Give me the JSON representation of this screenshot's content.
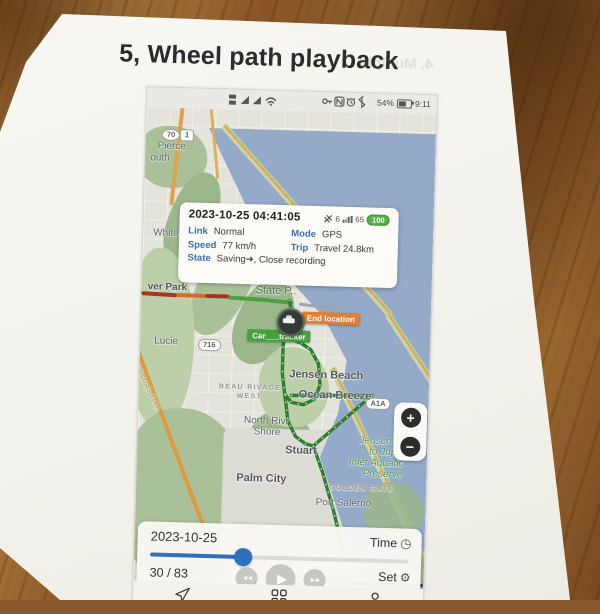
{
  "page": {
    "title": "5, Wheel path playback",
    "ghost_back_text": "4, Multiple"
  },
  "phone": {
    "status_bar": {
      "battery_percent": "54%",
      "time": "9:11"
    },
    "info_popup": {
      "datetime": "2023-10-25 04:41:05",
      "satellites": "6",
      "signal": "65",
      "battery": "100",
      "link_label": "Link",
      "link_value": "Normal",
      "mode_label": "Mode",
      "mode_value": "GPS",
      "speed_label": "Speed",
      "speed_value": "77 km/h",
      "trip_label": "Trip",
      "trip_value": "Travel 24.8km",
      "state_label": "State",
      "state_value": "Saving➔, Close recording"
    },
    "map": {
      "shields": {
        "s70": "70",
        "s1": "1",
        "s716": "716",
        "a1a": "A1A"
      },
      "labels": {
        "pierce": "Pierce",
        "south": "outh",
        "white_city": "White C",
        "river_park": "ver Park",
        "lucie": "Lucie",
        "preserve1": "Preserve",
        "preserve2": "State P..",
        "tpke": "Florida's Tpke",
        "beau1": "BEAU RIVAGE",
        "beau2": "WEST",
        "jensen_beach": "Jensen Beach",
        "ocean_breeze": "Ocean Breeze",
        "nriver1": "North Rivr",
        "nriver2": "Shore",
        "stuart": "Stuart",
        "aq1": "Jensen Be",
        "aq2": "to Jupit",
        "aq3": "Inlet Aquatic",
        "aq4": "Preserve",
        "palm_city": "Palm City",
        "golden_gate": "GOLDEN GATE",
        "port_salerno": "Port Salerno",
        "preserve_bottom": "Preserve",
        "watermark": "Google Map"
      },
      "markers": {
        "end_location": "End location",
        "car_tracker": "Car___tracker"
      },
      "zoom_in": "+",
      "zoom_out": "−"
    },
    "playback": {
      "date": "2023-10-25",
      "time_label": "Time",
      "counter": "30 / 83",
      "set_label": "Set",
      "progress_percent": 36,
      "play_glyph": "▶",
      "rew_glyph": "◄◄",
      "fwd_glyph": "►►",
      "time_icon": "◷",
      "set_icon": "⚙"
    }
  },
  "colors": {
    "accent_blue": "#2f6fc0",
    "end_orange": "#e07f38",
    "tracker_green": "#46a03d",
    "battery_green": "#56b14b",
    "water": "#94aac8",
    "route_green": "#2f7d33"
  }
}
